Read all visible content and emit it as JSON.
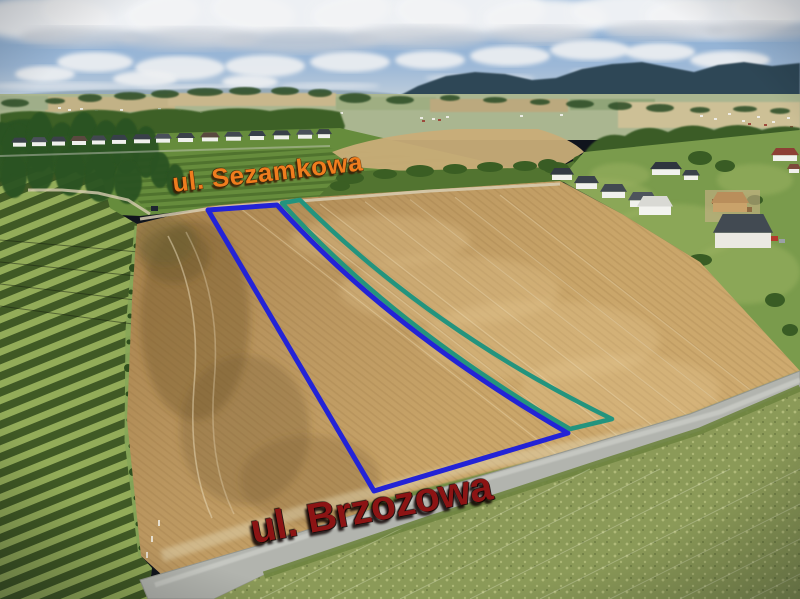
{
  "photo": {
    "type": "aerial-drone-photo-of-building-plots",
    "streets": [
      {
        "id": "sezamkowa",
        "text": "ul. Sezamkowa",
        "color": "#ef7d1e",
        "outline": "rgba(58,30,5,0.9)",
        "x": 171,
        "y": 170,
        "rot": -6.5,
        "size": 26,
        "spacing": 0.5
      },
      {
        "id": "brzozowa",
        "text": "ul. Brzozowa",
        "color": "#8c1414",
        "outline": "rgba(12,0,0,0.85)",
        "x": 247,
        "y": 509,
        "rot": -10.5,
        "size": 41,
        "spacing": -0.5
      }
    ],
    "parcels": [
      {
        "id": "parcel-boundary-blue",
        "color": "#2323d6",
        "width": 5,
        "d": "M208,210 L277,205 Q390,330 568,433 L374,491 Z"
      },
      {
        "id": "parcel-boundary-teal",
        "color": "#23947e",
        "width": 4.5,
        "d": "M282,203 L300,200 Q430,330 612,419 L570,429 Q393,326 282,203 Z"
      }
    ],
    "palette": {
      "sky": "#8fb3d8",
      "cloud": "#f3f4f6",
      "distant_hills": "#2e4756",
      "wheat_field": "#c8a369",
      "orchard": "#93ac59",
      "meadow": "#8b9a58",
      "road": "#b2b4ae"
    }
  }
}
